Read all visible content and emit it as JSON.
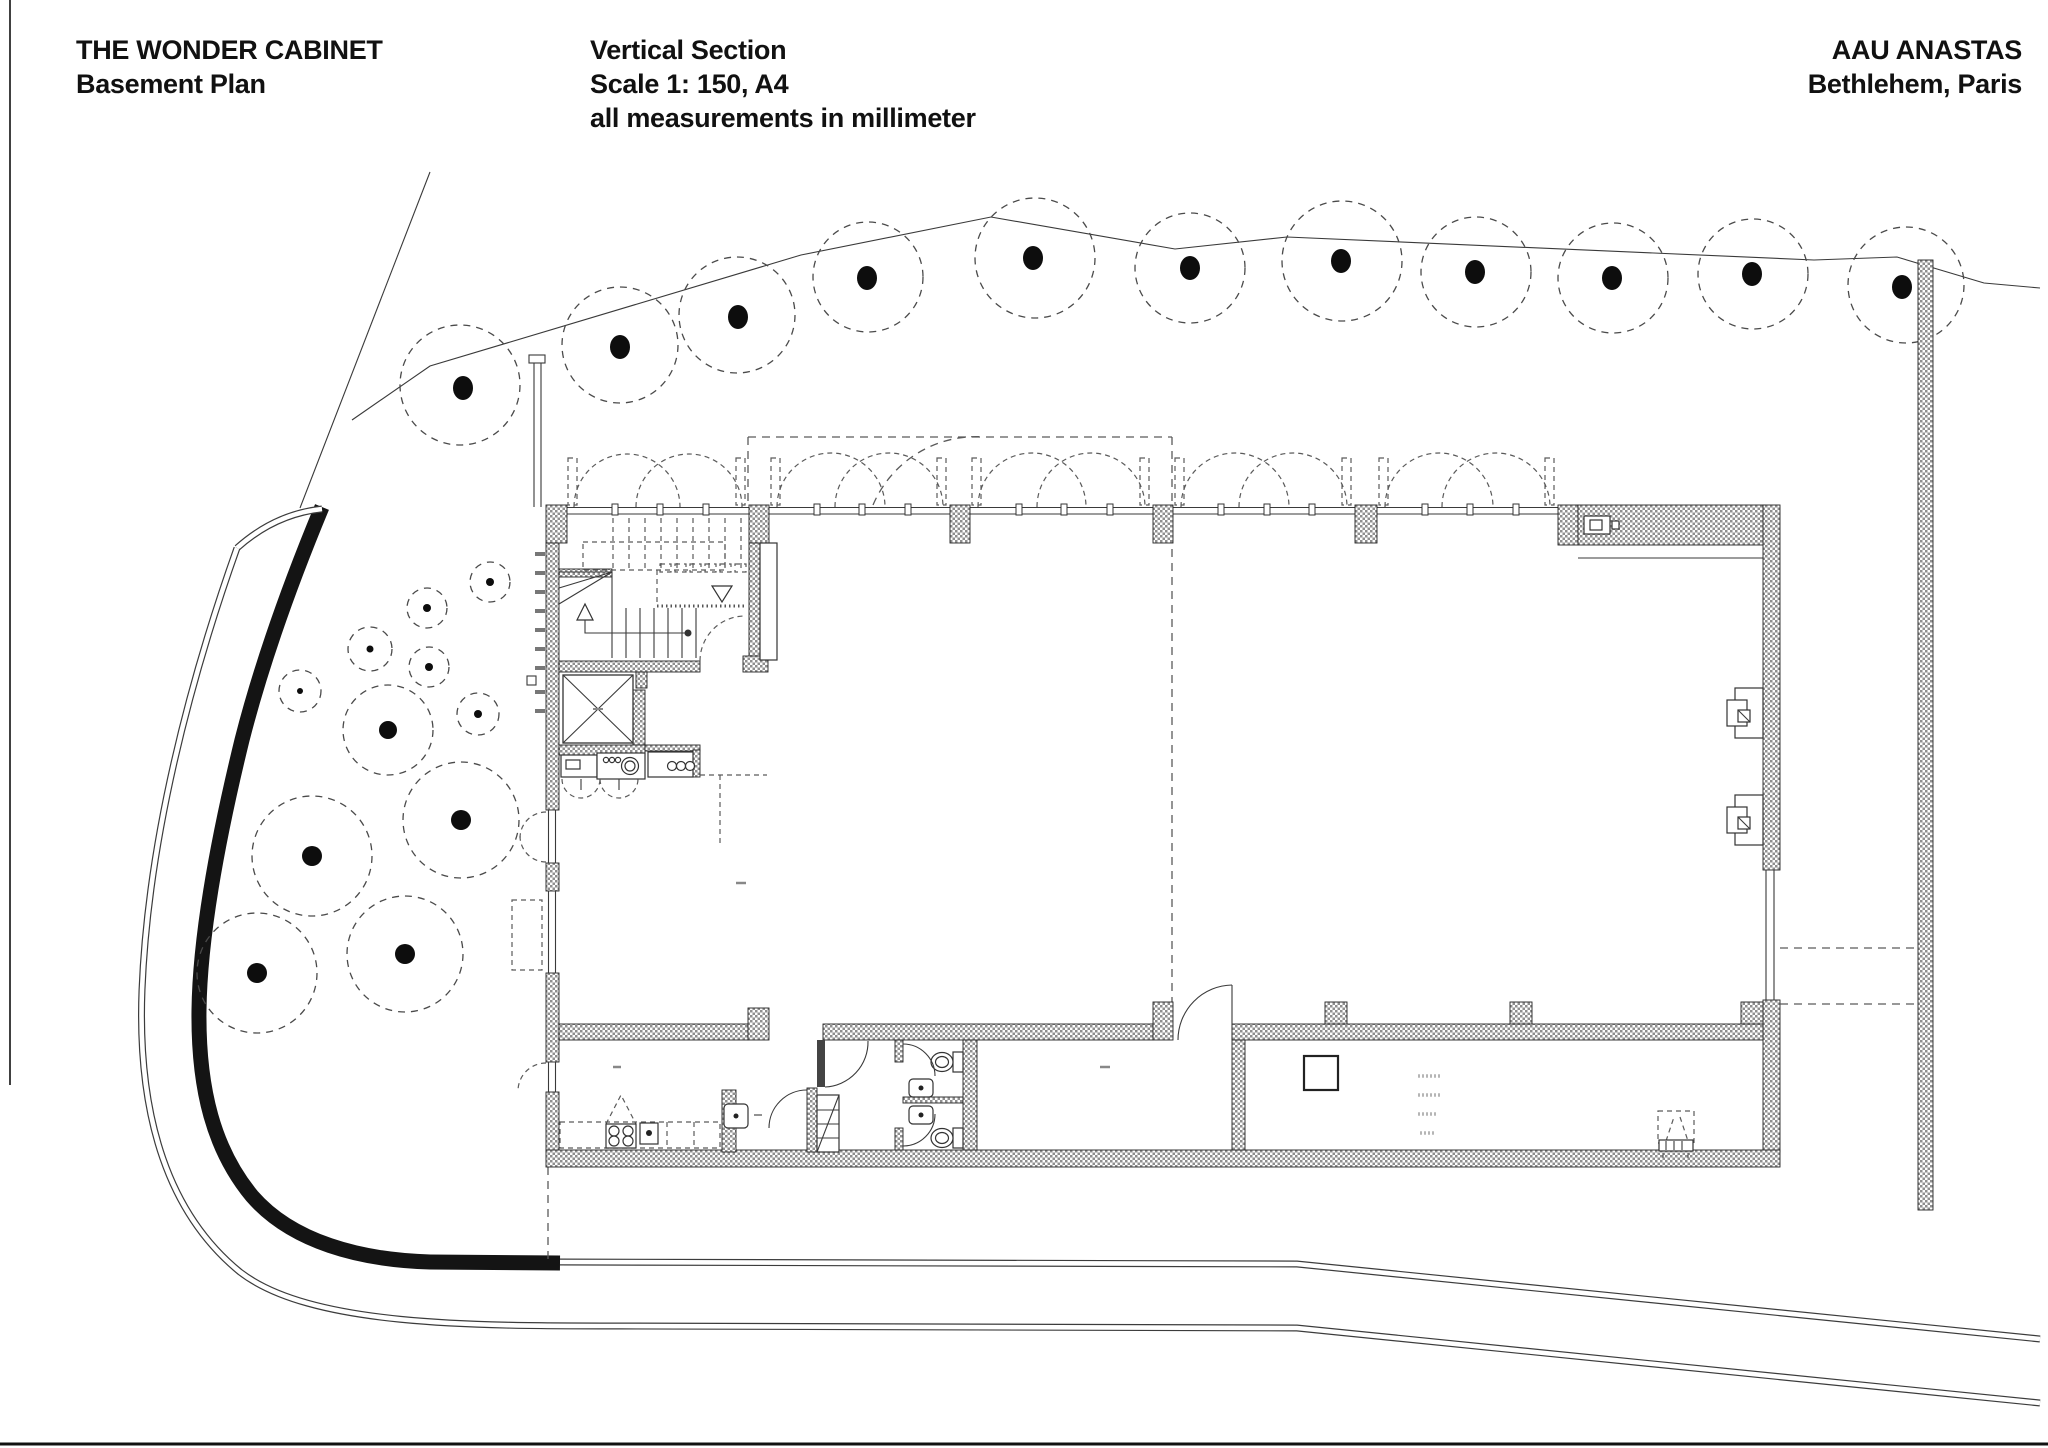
{
  "header": {
    "project": "THE WONDER CABINET",
    "sheet": "Basement Plan",
    "drawing_type": "Vertical Section",
    "scale": "Scale 1: 150, A4",
    "units_note": "all measurements in millimeter",
    "office": "AAU ANASTAS",
    "location": "Bethlehem, Paris"
  },
  "colors": {
    "ink": "#111111",
    "line": "#3a3a3a",
    "dashed": "#5a5a5a",
    "wall_hatch": "#8f8f8f",
    "site_wall_band": "#141414",
    "paper": "#ffffff"
  },
  "legend": {
    "hatched_fill": "cut masonry wall",
    "dashed_circles": "trees",
    "dashed_arcs": "door swings / arches above",
    "thick_black_band": "site retaining wall"
  }
}
